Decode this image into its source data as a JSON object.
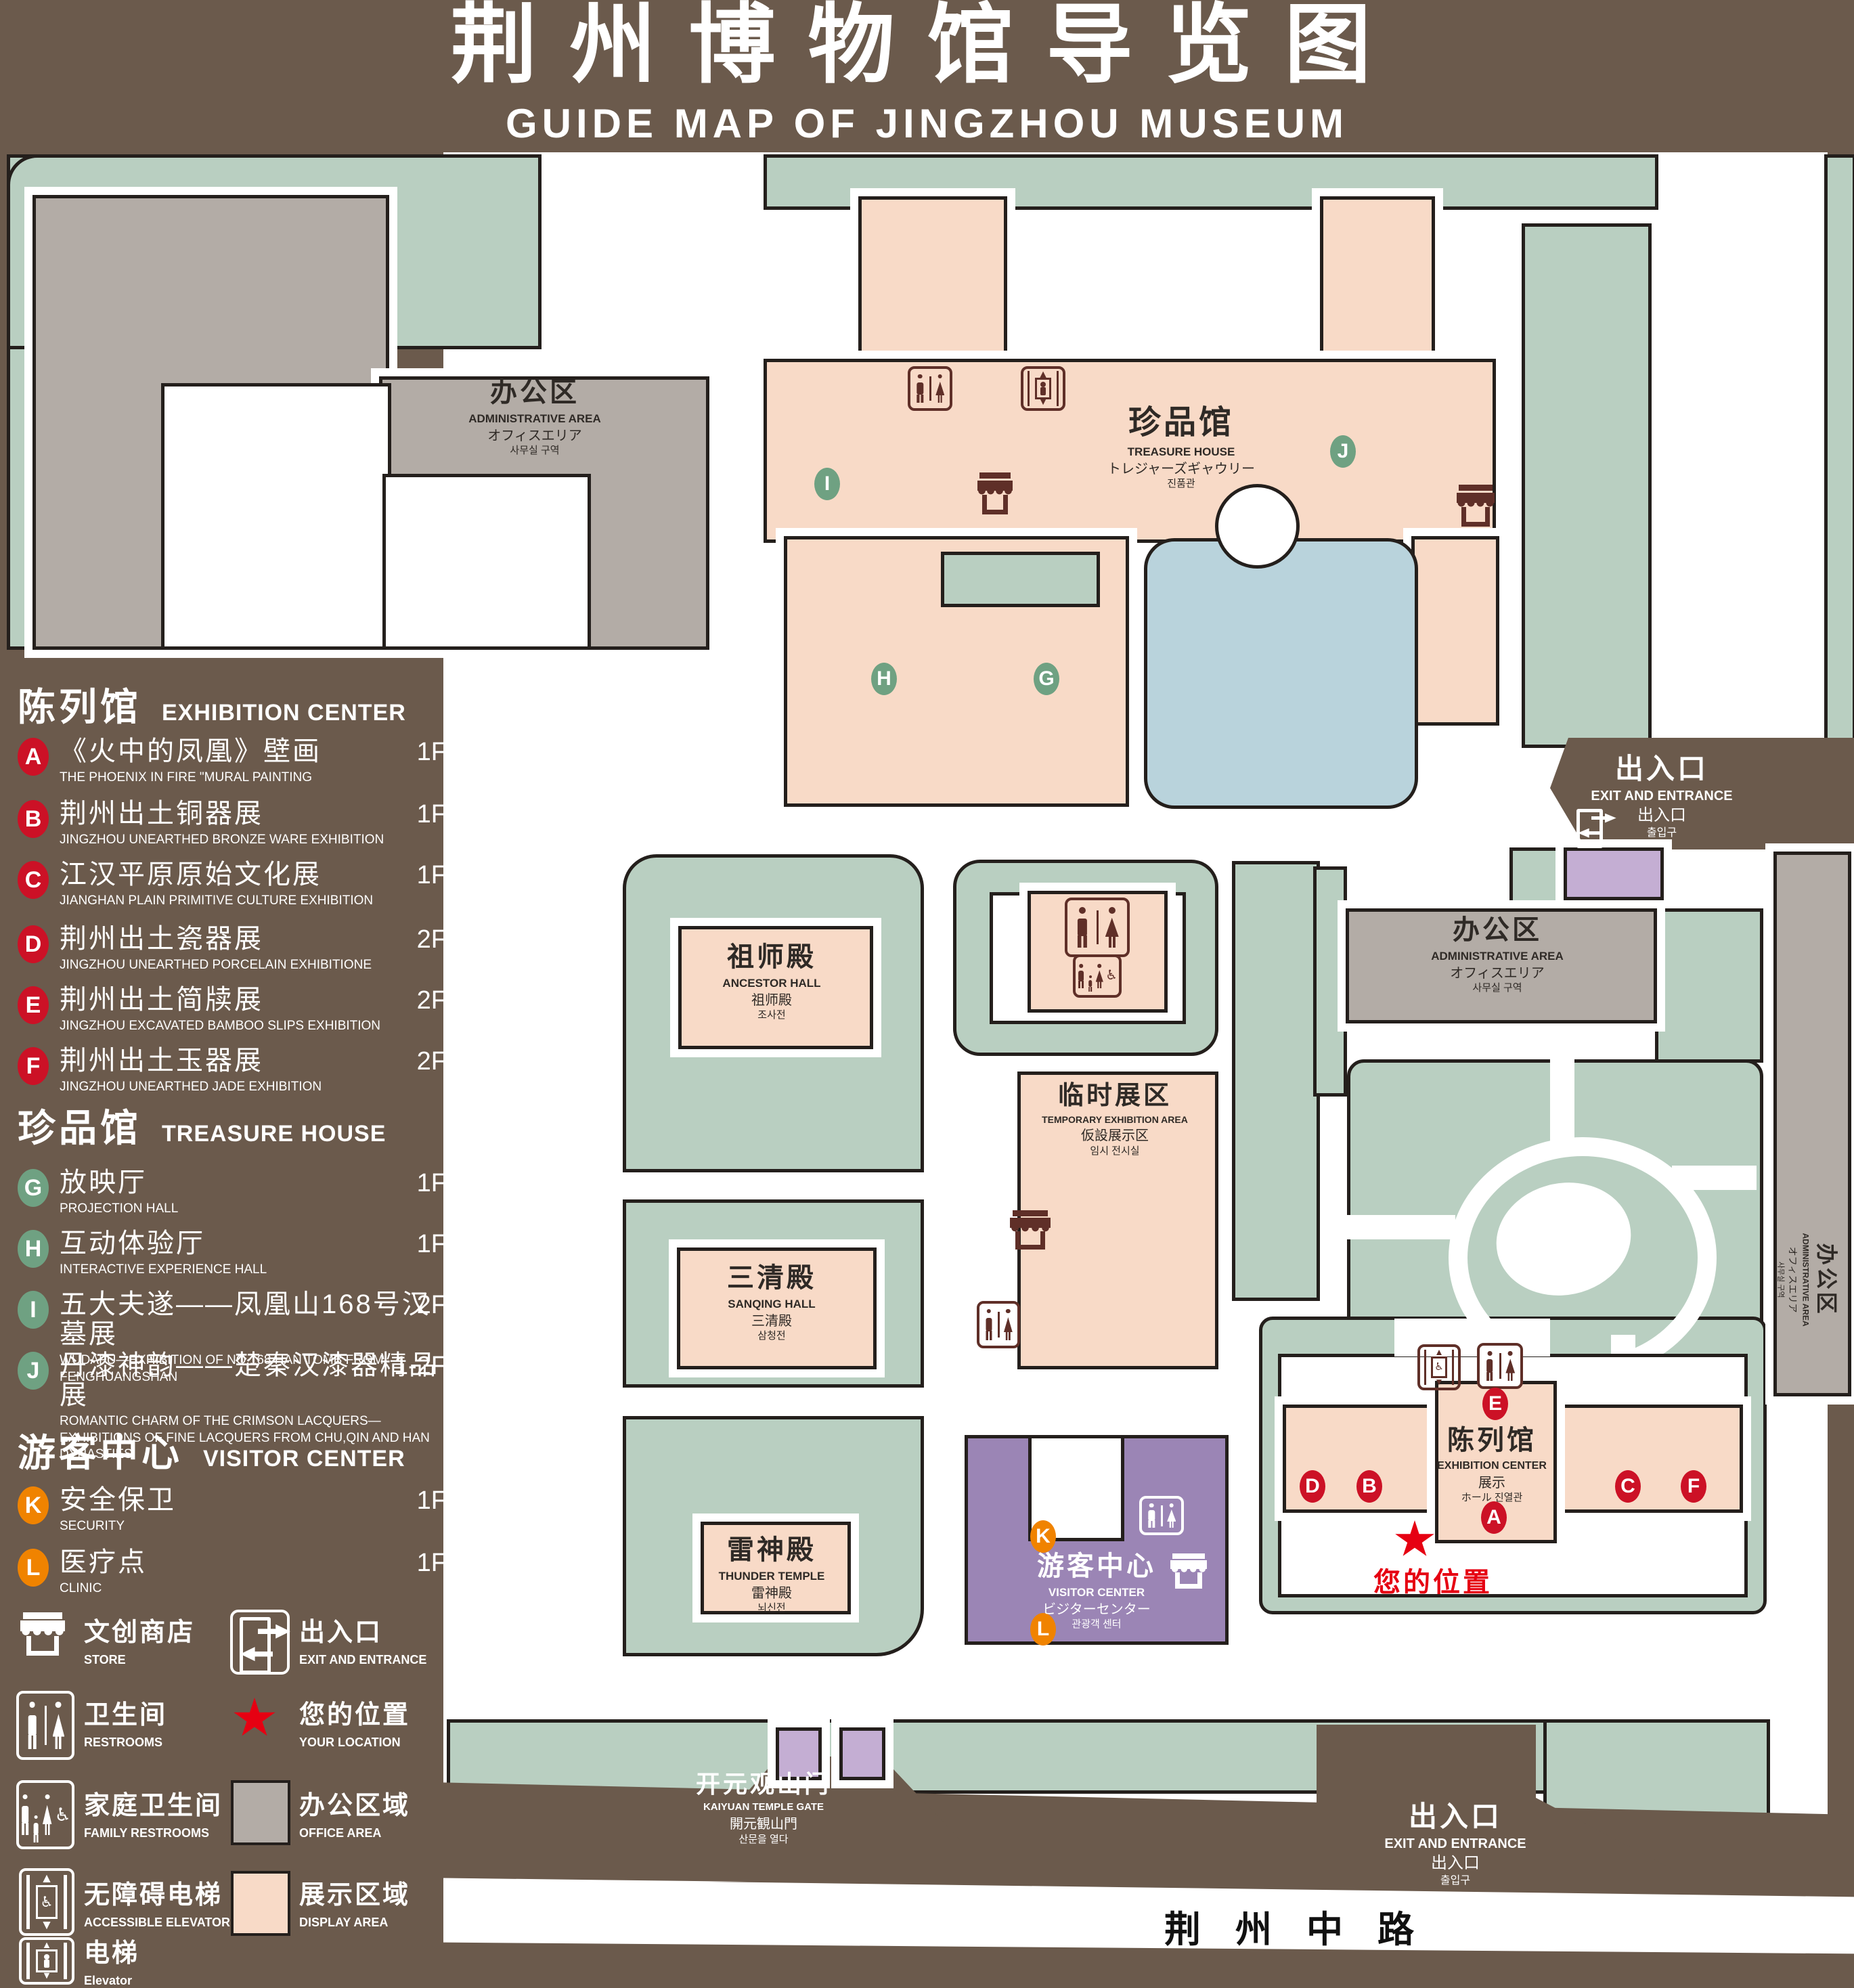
{
  "title": {
    "zh": "荆州博物馆导览图",
    "en": "GUIDE MAP OF JINGZHOU MUSEUM"
  },
  "letters": {
    "A": "A",
    "B": "B",
    "C": "C",
    "D": "D",
    "E": "E",
    "F": "F",
    "G": "G",
    "H": "H",
    "I": "I",
    "J": "J",
    "K": "K",
    "L": "L"
  },
  "legend": {
    "sections": [
      {
        "zh": "陈列馆",
        "en": "EXHIBITION CENTER"
      },
      {
        "zh": "珍品馆",
        "en": "TREASURE HOUSE"
      },
      {
        "zh": "游客中心",
        "en": "VISITOR CENTER"
      }
    ],
    "items": {
      "A": {
        "zh": "《火中的凤凰》壁画",
        "en": "THE PHOENIX IN FIRE \"MURAL PAINTING",
        "floor": "1F"
      },
      "B": {
        "zh": "荆州出土铜器展",
        "en": "JINGZHOU UNEARTHED BRONZE WARE EXHIBITION",
        "floor": "1F"
      },
      "C": {
        "zh": "江汉平原原始文化展",
        "en": "JIANGHAN PLAIN PRIMITIVE CULTURE EXHIBITION",
        "floor": "1F"
      },
      "D": {
        "zh": "荆州出土瓷器展",
        "en": "JINGZHOU UNEARTHED PORCELAIN EXHIBITIONE",
        "floor": "2F"
      },
      "E": {
        "zh": "荆州出土简牍展",
        "en": "JINGZHOU EXCAVATED BAMBOO SLIPS EXHIBITION",
        "floor": "2F"
      },
      "F": {
        "zh": "荆州出土玉器展",
        "en": "JINGZHOU UNEARTHED JADE EXHIBITION",
        "floor": "2F"
      },
      "G": {
        "zh": "放映厅",
        "en": "PROJECTION HALL",
        "floor": "1F"
      },
      "H": {
        "zh": "互动体验厅",
        "en": "INTERACTIVE EXPERIENCE HALL",
        "floor": "1F"
      },
      "I": {
        "zh": "五大夫遂——凤凰山168号汉墓展",
        "en": "WUDAFU—EXHIBITION OF NO.168 HAN TOMB FROM FENGHUANGSHAN",
        "floor": "2F"
      },
      "J": {
        "zh": "丹漆神韵——楚秦汉漆器精品展",
        "en": "ROMANTIC CHARM OF THE CRIMSON LACQUERS—EXHIBITIONS OF FINE LACQUERS FROM CHU,QIN AND HAN DYNASTIES",
        "floor": "1-2F"
      },
      "K": {
        "zh": "安全保卫",
        "en": "SECURITY",
        "floor": "1F"
      },
      "L": {
        "zh": "医疗点",
        "en": "CLINIC",
        "floor": "1F"
      }
    },
    "icons": {
      "store": {
        "zh": "文创商店",
        "en": "STORE"
      },
      "restrooms": {
        "zh": "卫生间",
        "en": "RESTROOMS"
      },
      "family": {
        "zh": "家庭卫生间",
        "en": "FAMILY RESTROOMS"
      },
      "accessible": {
        "zh": "无障碍电梯",
        "en": "ACCESSIBLE ELEVATOR"
      },
      "elevator": {
        "zh": "电梯",
        "en": "Elevator"
      },
      "exit": {
        "zh": "出入口",
        "en": "EXIT AND ENTRANCE"
      },
      "location": {
        "zh": "您的位置",
        "en": "YOUR LOCATION"
      },
      "office": {
        "zh": "办公区域",
        "en": "OFFICE AREA"
      },
      "display": {
        "zh": "展示区域",
        "en": "DISPLAY AREA"
      }
    }
  },
  "map": {
    "admin": {
      "zh": "办公区",
      "en": "ADMINISTRATIVE AREA",
      "ja": "オフィスエリア",
      "ko": "사무실 구역"
    },
    "treasure": {
      "zh": "珍品馆",
      "en": "TREASURE HOUSE",
      "ja": "トレジャーズギャウリー",
      "ko": "진품관"
    },
    "ancestor": {
      "zh": "祖师殿",
      "en": "ANCESTOR HALL",
      "ja": "祖师殿",
      "ko": "조사전"
    },
    "temporary": {
      "zh": "临时展区",
      "en": "TEMPORARY EXHIBITION AREA",
      "ja": "仮設展示区",
      "ko": "임시 전시실"
    },
    "sanqing": {
      "zh": "三清殿",
      "en": "SANQING HALL",
      "ja": "三清殿",
      "ko": "삼청전"
    },
    "thunder": {
      "zh": "雷神殿",
      "en": "THUNDER TEMPLE",
      "ja": "雷神殿",
      "ko": "뇌신전"
    },
    "visitor": {
      "zh": "游客中心",
      "en": "VISITOR CENTER",
      "ja": "ビジターセンター",
      "ko": "관광객 센터"
    },
    "exhibition": {
      "zh": "陈列馆",
      "en": "EXHIBITION CENTER",
      "ja": "展示",
      "ko": "ホール 진열관"
    },
    "exit": {
      "zh": "出入口",
      "en": "EXIT AND ENTRANCE",
      "ja": "出入口",
      "ko": "출입구"
    },
    "gate": {
      "zh": "开元观山门",
      "en": "KAIYUAN TEMPLE GATE",
      "ja": "開元観山門",
      "ko": "산문을 열다"
    },
    "road": "荆 州 中 路",
    "your_location": "您的位置"
  },
  "colors": {
    "background": "#6b5a4c",
    "lawn": "#b9cfc1",
    "office": "#b3aca6",
    "display": "#f8dac7",
    "water": "#b9d3dc",
    "purple": "#9b85b5",
    "lavender": "#c4aed3",
    "badge_red": "#cc1126",
    "badge_green": "#6fa182",
    "badge_orange": "#f08300",
    "star_red": "#e60012",
    "outline": "#241f1c",
    "icon_brown": "#5f2f28",
    "label_dark": "#2f2a26"
  }
}
